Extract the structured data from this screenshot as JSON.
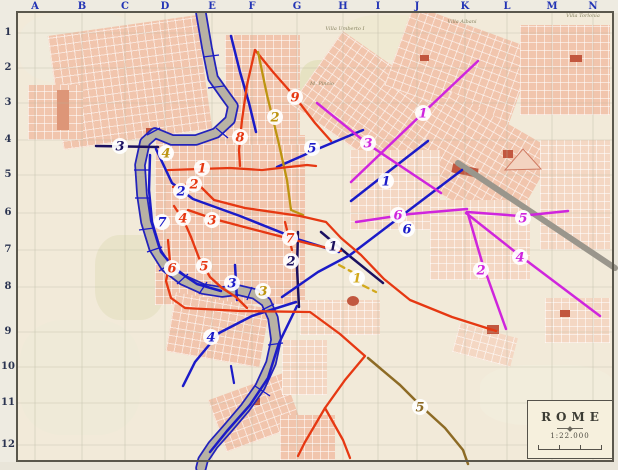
{
  "palette": {
    "blue": "#1b1bc8",
    "navy": "#1b1060",
    "red": "#e63812",
    "magenta": "#cf25dd",
    "olive": "#bd9410",
    "yellow": "#d2a91c",
    "brown": "#8d6b25",
    "river_fill": "#b8b2a4",
    "river_edge": "#2323bb",
    "rail": "#9a968c",
    "grid": "#b6b49e",
    "axis_letters": "#2334b5",
    "axis_numbers": "#2a3350"
  },
  "top_axis": {
    "labels": [
      "A",
      "B",
      "C",
      "D",
      "E",
      "F",
      "G",
      "H",
      "I",
      "J",
      "K",
      "L",
      "M",
      "N"
    ],
    "x": [
      35,
      82,
      125,
      165,
      212,
      252,
      297,
      343,
      378,
      417,
      465,
      507,
      552,
      593
    ]
  },
  "left_axis": {
    "labels": [
      "1",
      "2",
      "3",
      "4",
      "5",
      "6",
      "7",
      "8",
      "9",
      "10",
      "11",
      "12"
    ],
    "y": [
      33,
      68,
      103,
      140,
      175,
      213,
      250,
      287,
      332,
      367,
      403,
      445
    ]
  },
  "grid": {
    "cols_x": [
      35,
      82,
      125,
      165,
      212,
      252,
      297,
      343,
      378,
      417,
      465,
      507,
      552,
      593
    ],
    "rows_y": [
      33,
      68,
      103,
      140,
      175,
      213,
      250,
      287,
      332,
      367,
      403,
      445
    ]
  },
  "river": {
    "points": [
      [
        201,
        13
      ],
      [
        207,
        48
      ],
      [
        213,
        78
      ],
      [
        225,
        95
      ],
      [
        233,
        106
      ],
      [
        230,
        120
      ],
      [
        216,
        133
      ],
      [
        196,
        140
      ],
      [
        172,
        140
      ],
      [
        155,
        133
      ],
      [
        145,
        142
      ],
      [
        140,
        165
      ],
      [
        142,
        195
      ],
      [
        146,
        222
      ],
      [
        154,
        248
      ],
      [
        166,
        267
      ],
      [
        183,
        280
      ],
      [
        203,
        289
      ],
      [
        222,
        292
      ],
      [
        238,
        290
      ],
      [
        255,
        294
      ],
      [
        266,
        302
      ],
      [
        273,
        318
      ],
      [
        276,
        340
      ],
      [
        271,
        363
      ],
      [
        260,
        387
      ],
      [
        245,
        408
      ],
      [
        228,
        428
      ],
      [
        213,
        445
      ],
      [
        203,
        460
      ],
      [
        201,
        468
      ]
    ]
  },
  "bridges": [
    [
      203,
      57,
      219,
      55
    ],
    [
      208,
      88,
      224,
      86
    ],
    [
      216,
      128,
      228,
      138
    ],
    [
      147,
      135,
      160,
      128
    ],
    [
      134,
      170,
      149,
      170
    ],
    [
      135,
      198,
      150,
      198
    ],
    [
      139,
      230,
      154,
      228
    ],
    [
      147,
      252,
      162,
      247
    ],
    [
      159,
      271,
      172,
      263
    ],
    [
      177,
      284,
      188,
      274
    ],
    [
      199,
      294,
      207,
      282
    ],
    [
      247,
      300,
      252,
      287
    ],
    [
      262,
      310,
      274,
      304
    ],
    [
      268,
      345,
      283,
      343
    ],
    [
      255,
      386,
      270,
      396
    ]
  ],
  "railway": {
    "points": [
      [
        458,
        163
      ],
      [
        615,
        268
      ]
    ],
    "width": 6
  },
  "cemetery_triangle": [
    [
      505,
      170
    ],
    [
      523,
      149
    ],
    [
      541,
      169
    ]
  ],
  "routes": [
    {
      "color": "navy",
      "width": 2.5,
      "points": [
        [
          96,
          146
        ],
        [
          158,
          147
        ]
      ]
    },
    {
      "color": "navy",
      "width": 2.5,
      "points": [
        [
          298,
          232
        ],
        [
          297,
          268
        ],
        [
          299,
          307
        ]
      ]
    },
    {
      "color": "navy",
      "width": 2.5,
      "points": [
        [
          321,
          232
        ],
        [
          352,
          258
        ],
        [
          383,
          283
        ]
      ]
    },
    {
      "color": "blue",
      "width": 2.5,
      "points": [
        [
          277,
          167
        ],
        [
          320,
          148
        ],
        [
          363,
          130
        ]
      ]
    },
    {
      "color": "blue",
      "width": 2.5,
      "points": [
        [
          351,
          201
        ],
        [
          388,
          172
        ],
        [
          428,
          141
        ]
      ]
    },
    {
      "color": "blue",
      "width": 2.5,
      "points": [
        [
          156,
          149
        ],
        [
          172,
          183
        ],
        [
          193,
          199
        ],
        [
          240,
          216
        ],
        [
          300,
          240
        ],
        [
          339,
          252
        ]
      ]
    },
    {
      "color": "blue",
      "width": 2.5,
      "points": [
        [
          282,
          297
        ],
        [
          318,
          272
        ],
        [
          350,
          255
        ],
        [
          462,
          170
        ]
      ]
    },
    {
      "color": "blue",
      "width": 2.5,
      "points": [
        [
          150,
          155
        ],
        [
          149,
          190
        ],
        [
          152,
          222
        ],
        [
          161,
          252
        ],
        [
          176,
          270
        ],
        [
          197,
          284
        ],
        [
          221,
          291
        ]
      ]
    },
    {
      "color": "blue",
      "width": 2.5,
      "points": [
        [
          235,
          265
        ],
        [
          237,
          300
        ]
      ]
    },
    {
      "color": "blue",
      "width": 2.5,
      "points": [
        [
          296,
          302
        ],
        [
          252,
          316
        ],
        [
          219,
          333
        ],
        [
          195,
          362
        ],
        [
          183,
          386
        ]
      ]
    },
    {
      "color": "blue",
      "width": 2.5,
      "points": [
        [
          297,
          306
        ],
        [
          279,
          343
        ],
        [
          268,
          378
        ],
        [
          250,
          405
        ],
        [
          227,
          431
        ],
        [
          210,
          452
        ]
      ]
    },
    {
      "color": "blue",
      "width": 2.2,
      "points": [
        [
          231,
          366
        ],
        [
          234,
          383
        ]
      ]
    },
    {
      "color": "blue",
      "width": 2.5,
      "points": [
        [
          231,
          36
        ],
        [
          240,
          72
        ],
        [
          249,
          103
        ],
        [
          256,
          132
        ]
      ]
    },
    {
      "color": "red",
      "width": 2.3,
      "points": [
        [
          255,
          50
        ],
        [
          247,
          85
        ],
        [
          242,
          120
        ],
        [
          239,
          150
        ],
        [
          240,
          166
        ]
      ]
    },
    {
      "color": "red",
      "width": 2.3,
      "points": [
        [
          255,
          50
        ],
        [
          273,
          72
        ],
        [
          295,
          97
        ],
        [
          315,
          123
        ],
        [
          331,
          141
        ]
      ]
    },
    {
      "color": "olive",
      "width": 2.3,
      "points": [
        [
          258,
          52
        ],
        [
          267,
          95
        ],
        [
          278,
          140
        ],
        [
          287,
          180
        ],
        [
          291,
          210
        ],
        [
          303,
          215
        ]
      ]
    },
    {
      "color": "red",
      "width": 2.3,
      "points": [
        [
          168,
          170
        ],
        [
          230,
          168
        ],
        [
          262,
          170
        ],
        [
          307,
          165
        ],
        [
          316,
          166
        ]
      ]
    },
    {
      "color": "red",
      "width": 2.3,
      "points": [
        [
          173,
          187
        ],
        [
          197,
          183
        ],
        [
          214,
          200
        ],
        [
          245,
          208
        ],
        [
          300,
          216
        ],
        [
          326,
          222
        ],
        [
          341,
          238
        ],
        [
          361,
          255
        ],
        [
          384,
          279
        ],
        [
          410,
          300
        ],
        [
          452,
          317
        ],
        [
          496,
          331
        ]
      ]
    },
    {
      "color": "red",
      "width": 2.3,
      "points": [
        [
          188,
          210
        ],
        [
          214,
          219
        ],
        [
          248,
          228
        ],
        [
          310,
          244
        ],
        [
          341,
          251
        ]
      ]
    },
    {
      "color": "red",
      "width": 2.3,
      "points": [
        [
          174,
          206
        ],
        [
          184,
          221
        ],
        [
          191,
          237
        ]
      ]
    },
    {
      "color": "red",
      "width": 2.3,
      "points": [
        [
          191,
          237
        ],
        [
          199,
          258
        ],
        [
          210,
          277
        ],
        [
          222,
          288
        ],
        [
          236,
          297
        ],
        [
          247,
          308
        ]
      ]
    },
    {
      "color": "red",
      "width": 2.3,
      "points": [
        [
          168,
          240
        ],
        [
          170,
          262
        ],
        [
          166,
          281
        ],
        [
          171,
          298
        ],
        [
          185,
          308
        ],
        [
          240,
          311
        ],
        [
          310,
          312
        ],
        [
          340,
          334
        ],
        [
          365,
          356
        ],
        [
          345,
          380
        ],
        [
          325,
          408
        ],
        [
          305,
          442
        ],
        [
          298,
          456
        ]
      ]
    },
    {
      "color": "red",
      "width": 2.3,
      "points": [
        [
          325,
          408
        ],
        [
          343,
          440
        ],
        [
          350,
          458
        ]
      ]
    },
    {
      "color": "red",
      "width": 2.3,
      "points": [
        [
          285,
          222
        ],
        [
          292,
          250
        ]
      ]
    },
    {
      "color": "magenta",
      "width": 2.5,
      "points": [
        [
          478,
          61
        ],
        [
          422,
          114
        ],
        [
          351,
          182
        ]
      ]
    },
    {
      "color": "magenta",
      "width": 2.5,
      "points": [
        [
          317,
          103
        ],
        [
          369,
          145
        ],
        [
          441,
          193
        ]
      ]
    },
    {
      "color": "magenta",
      "width": 2.5,
      "points": [
        [
          356,
          222
        ],
        [
          410,
          214
        ],
        [
          467,
          209
        ]
      ]
    },
    {
      "color": "magenta",
      "width": 2.5,
      "points": [
        [
          467,
          212
        ],
        [
          520,
          216
        ],
        [
          568,
          211
        ]
      ]
    },
    {
      "color": "magenta",
      "width": 2.5,
      "points": [
        [
          466,
          213
        ],
        [
          523,
          258
        ],
        [
          600,
          316
        ]
      ]
    },
    {
      "color": "magenta",
      "width": 2.5,
      "points": [
        [
          468,
          214
        ],
        [
          482,
          262
        ],
        [
          492,
          290
        ],
        [
          506,
          329
        ]
      ]
    },
    {
      "color": "brown",
      "width": 2.5,
      "points": [
        [
          368,
          358
        ],
        [
          400,
          385
        ],
        [
          422,
          407
        ],
        [
          445,
          428
        ],
        [
          463,
          450
        ],
        [
          468,
          464
        ]
      ]
    },
    {
      "color": "yellow",
      "width": 2.3,
      "dash": "6,5",
      "points": [
        [
          339,
          265
        ],
        [
          354,
          273
        ],
        [
          360,
          284
        ],
        [
          376,
          292
        ]
      ]
    }
  ],
  "route_labels": [
    {
      "n": "3",
      "color": "navy",
      "x": 120,
      "y": 146
    },
    {
      "n": "1",
      "color": "navy",
      "x": 333,
      "y": 246
    },
    {
      "n": "2",
      "color": "navy",
      "x": 291,
      "y": 261
    },
    {
      "n": "5",
      "color": "blue",
      "x": 312,
      "y": 148
    },
    {
      "n": "1",
      "color": "blue",
      "x": 386,
      "y": 181
    },
    {
      "n": "2",
      "color": "blue",
      "x": 181,
      "y": 191
    },
    {
      "n": "7",
      "color": "blue",
      "x": 162,
      "y": 222
    },
    {
      "n": "6",
      "color": "blue",
      "x": 407,
      "y": 229
    },
    {
      "n": "3",
      "color": "blue",
      "x": 232,
      "y": 283
    },
    {
      "n": "4",
      "color": "blue",
      "x": 211,
      "y": 337
    },
    {
      "n": "9",
      "color": "red",
      "x": 295,
      "y": 97
    },
    {
      "n": "8",
      "color": "red",
      "x": 240,
      "y": 137
    },
    {
      "n": "1",
      "color": "red",
      "x": 202,
      "y": 168
    },
    {
      "n": "2",
      "color": "red",
      "x": 194,
      "y": 184
    },
    {
      "n": "4",
      "color": "red",
      "x": 183,
      "y": 218
    },
    {
      "n": "3",
      "color": "red",
      "x": 212,
      "y": 220
    },
    {
      "n": "7",
      "color": "red",
      "x": 290,
      "y": 238
    },
    {
      "n": "5",
      "color": "red",
      "x": 204,
      "y": 266
    },
    {
      "n": "6",
      "color": "red",
      "x": 172,
      "y": 268
    },
    {
      "n": "1",
      "color": "magenta",
      "x": 423,
      "y": 113
    },
    {
      "n": "3",
      "color": "magenta",
      "x": 368,
      "y": 143
    },
    {
      "n": "6",
      "color": "magenta",
      "x": 398,
      "y": 215
    },
    {
      "n": "5",
      "color": "magenta",
      "x": 523,
      "y": 218
    },
    {
      "n": "4",
      "color": "magenta",
      "x": 520,
      "y": 257
    },
    {
      "n": "2",
      "color": "magenta",
      "x": 481,
      "y": 270
    },
    {
      "n": "2",
      "color": "olive",
      "x": 275,
      "y": 117
    },
    {
      "n": "4",
      "color": "olive",
      "x": 166,
      "y": 153
    },
    {
      "n": "3",
      "color": "olive",
      "x": 263,
      "y": 291
    },
    {
      "n": "1",
      "color": "yellow",
      "x": 357,
      "y": 278
    },
    {
      "n": "5",
      "color": "brown",
      "x": 420,
      "y": 407
    }
  ],
  "place_labels": [
    {
      "text": "M. Pincio",
      "x": 322,
      "y": 84
    },
    {
      "text": "Villa Umberto I",
      "x": 345,
      "y": 29
    },
    {
      "text": "Villa Albani",
      "x": 462,
      "y": 22
    },
    {
      "text": "Villa Torlonia",
      "x": 583,
      "y": 16
    }
  ],
  "rome_box": {
    "title": "ROME",
    "scale": "1:22.000"
  }
}
